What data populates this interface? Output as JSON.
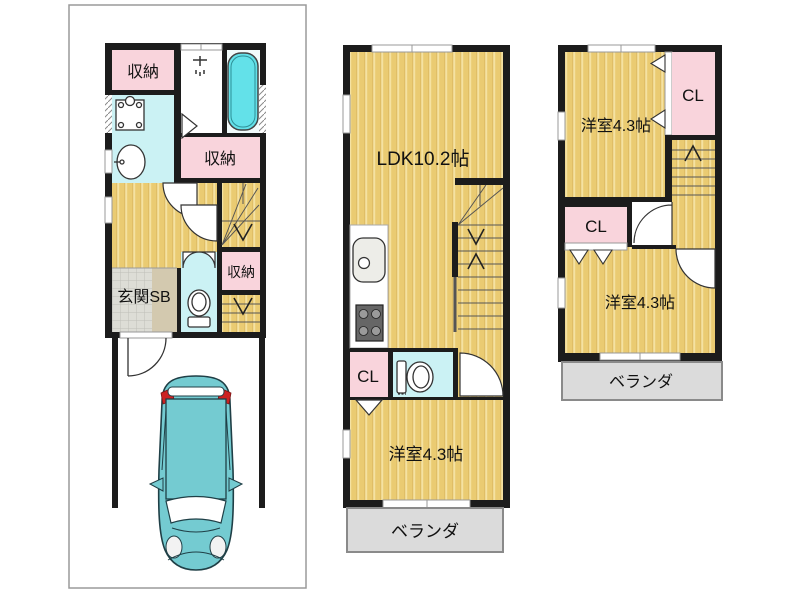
{
  "document": {
    "type": "real-estate-floorplan",
    "floors_shown": 3
  },
  "colors": {
    "wall": "#1c1c1c",
    "floor_tan": "#EACB72",
    "floor_tan_stripe": "#F5E2A2",
    "pink": "#F9D4DC",
    "cyan_room": "#CBF2F4",
    "bathtub": "#63E1E9",
    "tile_gray": "#DDDDD6",
    "beige": "#D3C9AF",
    "veranda_gray": "#DBDBDB",
    "car_teal": "#74CBD1",
    "car_tail_red": "#CC2222",
    "lot_border": "#9A9A9A",
    "white": "#FFFFFF"
  },
  "floor1": {
    "labels": {
      "storage_top": "収納",
      "storage_mid": "収納",
      "storage_small": "収納",
      "entrance": "玄関SB"
    }
  },
  "floor2": {
    "labels": {
      "ldk": "LDK10.2帖",
      "closet": "CL",
      "bedroom": "洋室4.3帖",
      "veranda": "ベランダ"
    }
  },
  "floor3": {
    "labels": {
      "bedroom_top": "洋室4.3帖",
      "closet_top": "CL",
      "closet_mid": "CL",
      "bedroom_bottom": "洋室4.3帖",
      "veranda": "ベランダ"
    }
  }
}
